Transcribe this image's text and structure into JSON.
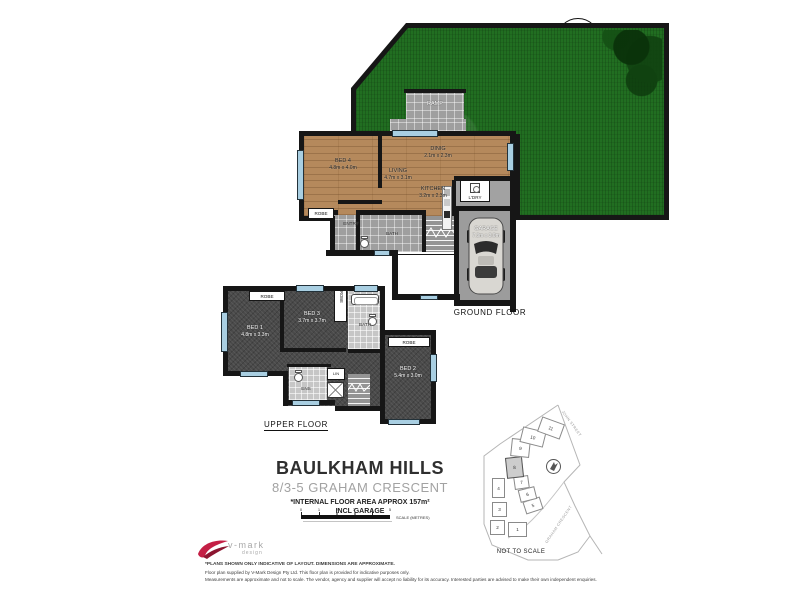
{
  "title": {
    "suburb": "BAULKHAM HILLS",
    "address": "8/3-5 GRAHAM CRESCENT",
    "area_line1": "*INTERNAL FLOOR AREA APPROX 157m²",
    "area_line2": "INCL GARAGE"
  },
  "scale": {
    "ticks": [
      "0",
      "1",
      "2",
      "3",
      "4",
      "5"
    ],
    "label": "SCALE (METRES)"
  },
  "north": {
    "letter": "N"
  },
  "ground": {
    "floor_label": "GROUND FLOOR",
    "rooms": {
      "bed4": {
        "name": "BED 4",
        "dims": "4.8m x 4.0m"
      },
      "living": {
        "name": "LIVING",
        "dims": "4.7m x 3.1m"
      },
      "dining": {
        "name": "DINIG",
        "dims": "2.1m x 2.3m"
      },
      "kitchen": {
        "name": "KITCHEN",
        "dims": "3.2m x 2.3m"
      },
      "garage": {
        "name": "GARAGE",
        "dims": "7.3m x 3.0m"
      },
      "laundry": "L'DRY",
      "robe": "ROBE",
      "entry": "ENTRY",
      "bath": "BATH",
      "ramp": "RAMP"
    }
  },
  "upper": {
    "floor_label": "UPPER FLOOR",
    "rooms": {
      "bed1": {
        "name": "BED 1",
        "dims": "4.8m x 3.3m"
      },
      "bed2": {
        "name": "BED 2",
        "dims": "5.4m x 3.0m"
      },
      "bed3": {
        "name": "BED 3",
        "dims": "3.7m x 3.7m"
      },
      "bath": "BATH",
      "ens": "ENS",
      "lin": "LIN",
      "robe1": "ROBE",
      "robe2": "ROBE",
      "robe3": "ROBE"
    }
  },
  "siteplan": {
    "lots": [
      "1",
      "2",
      "3",
      "4",
      "5",
      "6",
      "7",
      "8",
      "9",
      "10",
      "11"
    ],
    "highlighted_lot": "8",
    "street1": "JOHN STREET",
    "street2": "GRAHAM CRESCENT",
    "not_to_scale": "NOT TO SCALE",
    "north_letter": "N"
  },
  "footer": {
    "logo_main": "v-mark",
    "logo_sub": "design",
    "disclaimer1": "*PLANS SHOWN ONLY INDICATIVE OF LAYOUT. DIMENSIONS ARE APPROXIMATE.",
    "disclaimer2": "Floor plan supplied by V-Mark Design Pty Ltd. This floor plan is provided for indicative purposes only.",
    "disclaimer3": "Measurements are approximate and not to scale. The vendor, agency and supplier will accept no liability for its accuracy. Interested parties are advised to make their own independent enquiries."
  },
  "colors": {
    "wall": "#161616",
    "grass": "#216e21",
    "wood": "#b5895c",
    "carpet": "#4a4a4a",
    "window": "#a9cfe2",
    "logo_red": "#c41f45"
  }
}
